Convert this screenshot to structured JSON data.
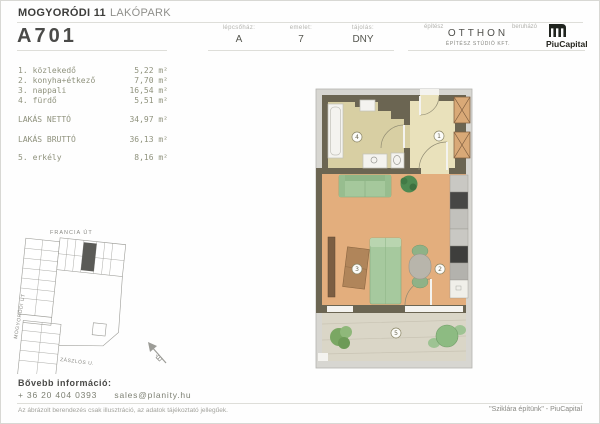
{
  "header": {
    "project_title_bold": "MOGYORÓDI 11",
    "project_title_light": "LAKÓPARK",
    "unit_code": "A701",
    "info_fields": [
      {
        "label": "lépcsőház:",
        "value": "A"
      },
      {
        "label": "emelet:",
        "value": "7"
      },
      {
        "label": "tájolás:",
        "value": "DNY"
      }
    ],
    "architect": {
      "label": "építész",
      "name": "OTTHON",
      "subtitle": "ÉPÍTÉSZ STÚDIÓ KFT."
    },
    "developer": {
      "label": "beruházó",
      "name": "PiuCapital"
    }
  },
  "room_list": {
    "rooms": [
      {
        "num": "1.",
        "name": "közlekedő",
        "area": "5,22 m²"
      },
      {
        "num": "2.",
        "name": "konyha+étkező",
        "area": "7,70 m²"
      },
      {
        "num": "3.",
        "name": "nappali",
        "area": "16,54 m²"
      },
      {
        "num": "4.",
        "name": "fürdő",
        "area": "5,51 m²"
      }
    ],
    "totals": [
      {
        "label": "LAKÁS NETTÓ",
        "area": "34,97 m²"
      },
      {
        "label": "LAKÁS BRUTTÓ",
        "area": "36,13 m²"
      }
    ],
    "outdoor": {
      "num": "5.",
      "name": "erkély",
      "area": "8,16 m²"
    }
  },
  "site_plan": {
    "street_top": "FRANCIA ÚT",
    "street_left": "MOGYORÓDI ÚT",
    "street_bottom": "ZÁSZLÓS U.",
    "north": "É"
  },
  "floor_plan": {
    "room_numbers": [
      "1",
      "2",
      "3",
      "4",
      "5"
    ]
  },
  "contact": {
    "heading": "Bővebb információ:",
    "phone": "+ 36 20 404 0393",
    "email": "sales@planity.hu"
  },
  "footer": {
    "disclaimer": "Az ábrázolt berendezés csak illusztráció, az adatok tájékoztató jellegűek.",
    "slogan": "\"Sziklára építünk\" - PiuCapital"
  },
  "colors": {
    "wall": "#6b6552",
    "wood_floor": "#e3ae7d",
    "bath_floor": "#d8cfa3",
    "hall_floor": "#e9e1bb",
    "balcony_floor": "#dad6c7",
    "furniture_green": "#a5c89c",
    "shaft_orange": "#d9a977",
    "frame_gray": "#d7d6d1"
  }
}
